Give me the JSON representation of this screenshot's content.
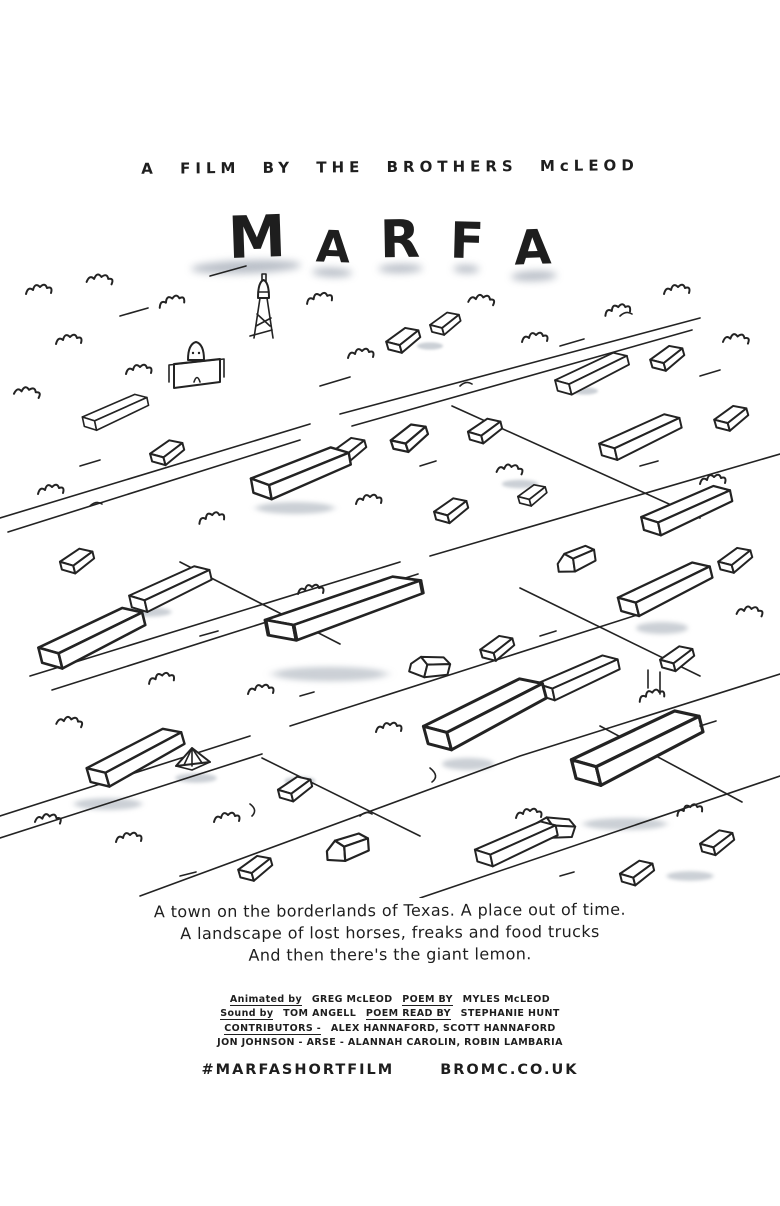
{
  "poster": {
    "byline": "A FILM BY THE BROTHERS McLEOD",
    "title": "MARFA",
    "title_letters": [
      "M",
      "A",
      "R",
      "F",
      "A"
    ],
    "tagline": [
      "A town on the borderlands of Texas. A place out of time.",
      "A landscape of lost horses, freaks and food trucks",
      "And then there's the giant lemon."
    ],
    "credits": {
      "line1": {
        "label1": "Animated by",
        "name1": "GREG McLEOD",
        "label2": "POEM BY",
        "name2": "MYLES McLEOD"
      },
      "line2": {
        "label1": "Sound by",
        "name1": "TOM ANGELL",
        "label2": "POEM READ BY",
        "name2": "STEPHANIE HUNT"
      },
      "line3": {
        "label1": "CONTRIBUTORS -",
        "name1": "ALEX HANNAFORD, SCOTT HANNAFORD"
      },
      "line4": {
        "name1": "JON JOHNSON - ARSE - ALANNAH CAROLIN, ROBIN LAMBARIA"
      }
    },
    "footer": {
      "hashtag": "#MARFASHORTFILM",
      "website": "BROMC.CO.UK"
    },
    "illustration_alt": "Hand-drawn ink aerial sketch of Marfa, Texas: water tower, church, low flat buildings along diagonal streets, scrub bushes, grey watercolour shading",
    "colors": {
      "ink": "#232323",
      "wash": "#97a0ac",
      "background": "#ffffff"
    }
  }
}
